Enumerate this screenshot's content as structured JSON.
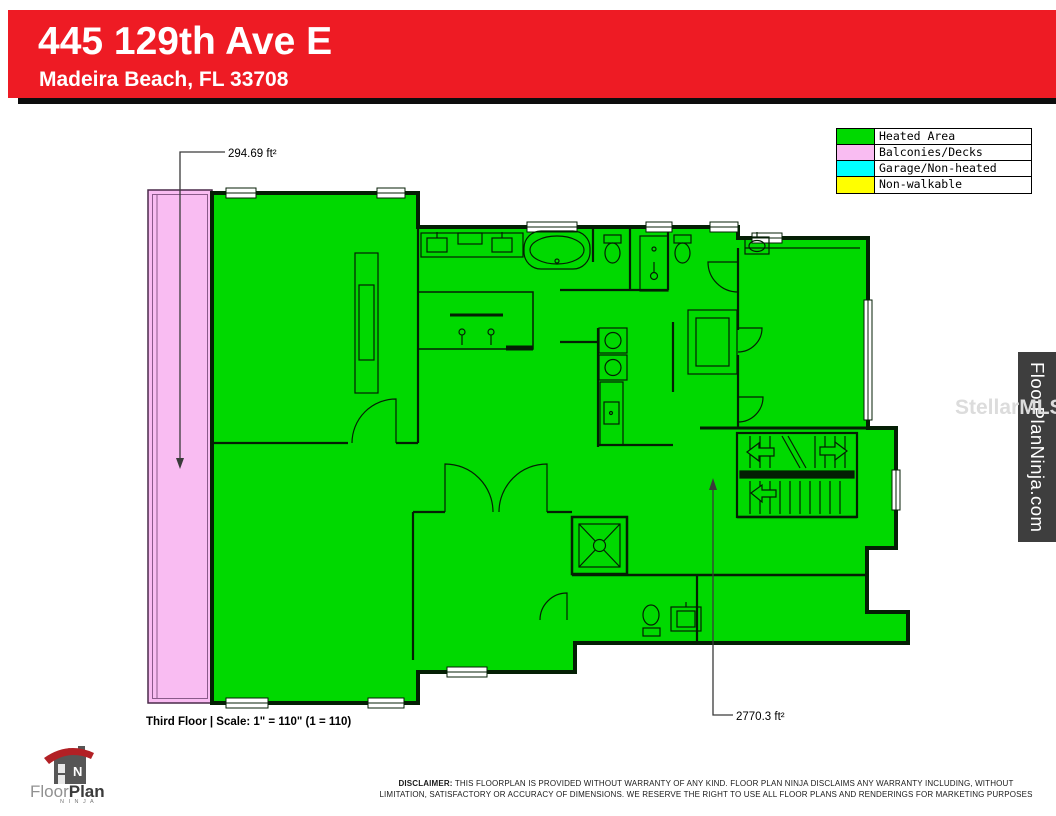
{
  "header": {
    "address": "445 129th Ave E",
    "city_state_zip": "Madeira Beach, FL 33708",
    "banner_color": "#EE1B24"
  },
  "legend": {
    "items": [
      {
        "label": "Heated Area",
        "color": "#00D900"
      },
      {
        "label": "Balconies/Decks",
        "color": "#F9BCF2"
      },
      {
        "label": "Garage/Non-heated",
        "color": "#00FFFF"
      },
      {
        "label": "Non-walkable",
        "color": "#FFFF00"
      }
    ]
  },
  "plan": {
    "balcony_area": "294.69 ft²",
    "heated_area": "2770.3 ft²",
    "floor_scale": "Third Floor | Scale: 1\" = 110\" (1 = 110)"
  },
  "branding": {
    "logo_floor": "Floor",
    "logo_plan": "Plan",
    "logo_ninja": "N I N J A",
    "side_banner": "FloorPlanNinja.com",
    "watermark": "StellarMLS"
  },
  "disclaimer": {
    "label": "DISCLAIMER:",
    "line1": " THIS FLOORPLAN IS PROVIDED WITHOUT WARRANTY OF ANY KIND. FLOOR PLAN NINJA DISCLAIMS ANY WARRANTY INCLUDING, WITHOUT",
    "line2": "LIMITATION, SATISFACTORY OR ACCURACY OF DIMENSIONS. WE RESERVE THE RIGHT TO USE ALL FLOOR PLANS AND RENDERINGS FOR MARKETING PURPOSES"
  }
}
